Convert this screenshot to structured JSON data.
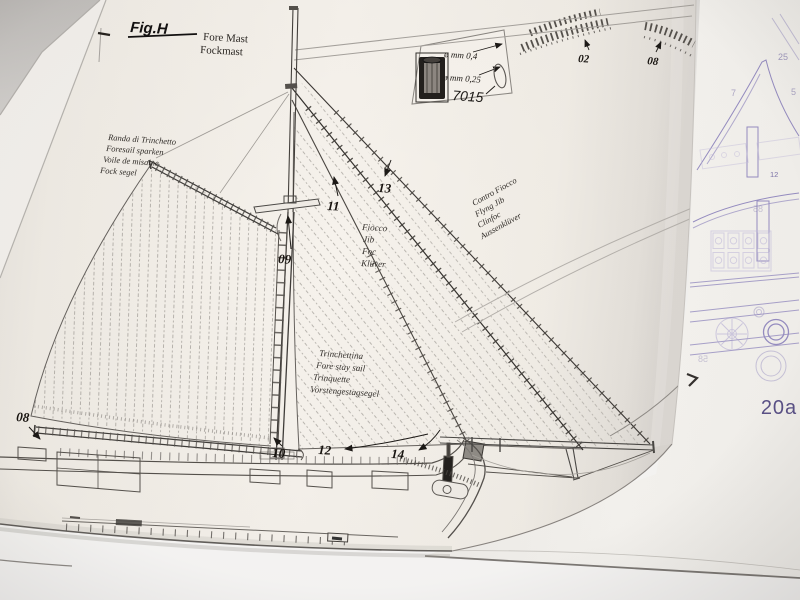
{
  "figure": {
    "fig_label": "Fig.H",
    "title_lines": [
      "Fore Mast",
      "Fockmast"
    ]
  },
  "thread_box": {
    "lines": [
      "ø mm 0,4",
      "ø mm 0,25"
    ],
    "part_number": "7015"
  },
  "callouts": {
    "gaff_inset": "02",
    "boom_inset": "08",
    "stay_inner": "11",
    "stay_outer": "13",
    "mast_cap": "09",
    "boom_end": "08",
    "mast_foot": "10",
    "staysail_tack": "12",
    "jib_tack": "14"
  },
  "sails": {
    "foresail": {
      "names": [
        "Randa di Trinchetto",
        "Foresail sparken",
        "Voile de misaine",
        "Fock segel"
      ]
    },
    "fore_staysail": {
      "names": [
        "Trinchettina",
        "Fore stay sail",
        "Trinquette",
        "Vorstengestagsegel"
      ]
    },
    "jib": {
      "names": [
        "Fiocco",
        "Jib",
        "Foc",
        "Klüver"
      ]
    },
    "flying_jib": {
      "names": [
        "Contro Fiocco",
        "Flyng Jib",
        "Clinfoc",
        "Aussenklüver"
      ]
    }
  },
  "parts_sheet": {
    "sheet_number": "20a",
    "labels": [
      "25",
      "7",
      "5",
      "12"
    ],
    "mirrored_labels": [
      "85",
      "58"
    ],
    "outline_color": "#968dc2",
    "text_color": "#5b5288"
  },
  "colors": {
    "ink": "#3a3633",
    "paper": "#f4f0ea",
    "purple": "#968dc2"
  }
}
